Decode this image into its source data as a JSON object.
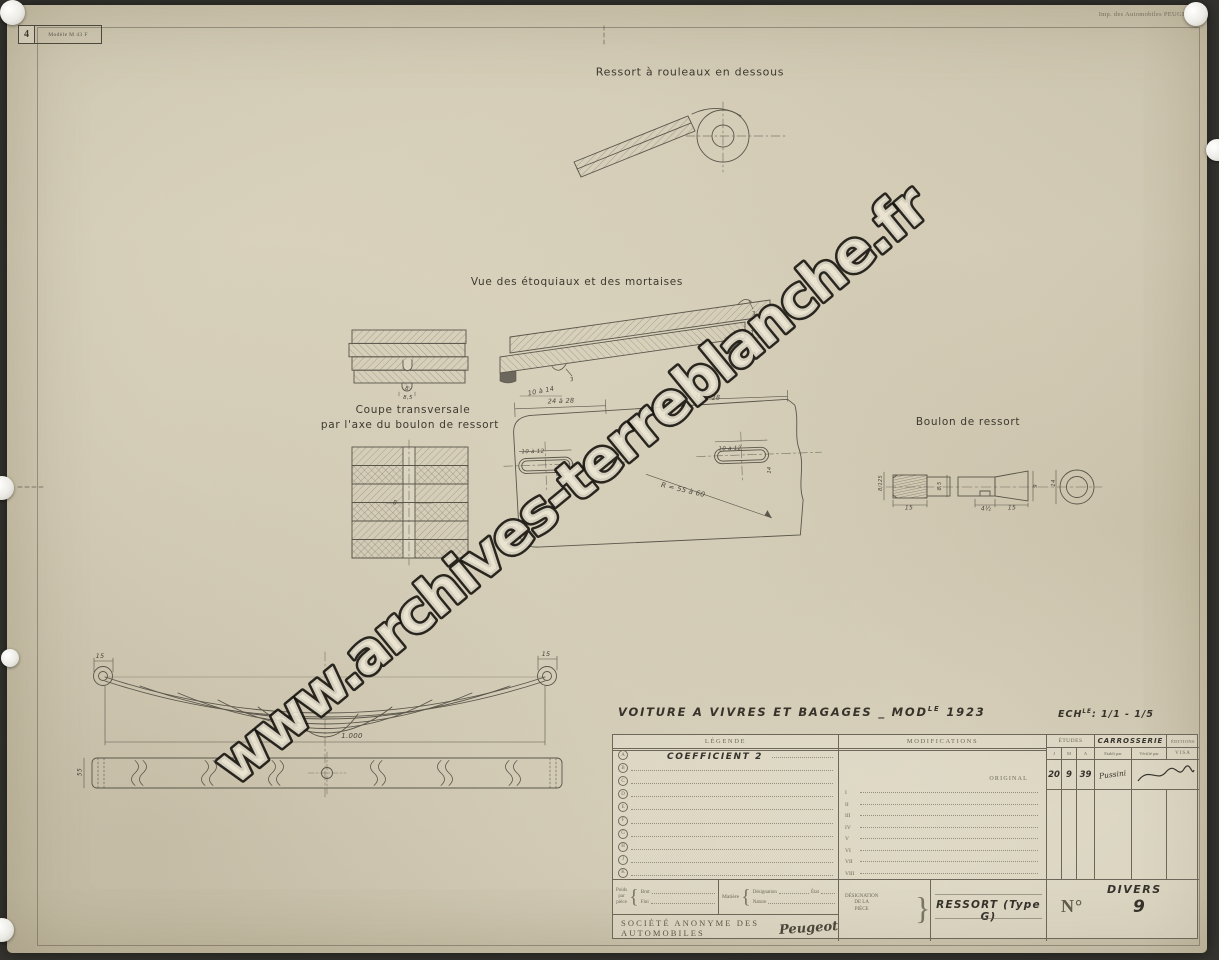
{
  "colors": {
    "paper": "#d9d2bd",
    "ink": "#56524a",
    "table_line": "#6d6759",
    "watermark_fill": "#ece6d4",
    "watermark_stroke": "#16130e"
  },
  "watermark": {
    "text": "www.archives-terreblanche.fr"
  },
  "stamp": {
    "number": "4",
    "model": "Modèle M 43 F"
  },
  "printer_note": "Imp. des Automobiles PEUGEOT.",
  "annotations": [
    {
      "t": "Ressort à rouleaux en dessous",
      "x": 690,
      "y": 72,
      "s": 11,
      "cls": "title"
    },
    {
      "t": "Vue des étoquiaux et des mortaises",
      "x": 577,
      "y": 282,
      "s": 10.5,
      "cls": "title"
    },
    {
      "t": "Coupe transversale",
      "x": 413,
      "y": 410,
      "s": 10.5,
      "cls": "title"
    },
    {
      "t": "par l'axe du boulon de ressort",
      "x": 410,
      "y": 425,
      "s": 10.5,
      "cls": "title"
    },
    {
      "t": "Boulon de ressort",
      "x": 968,
      "y": 422,
      "s": 10.5,
      "cls": "title"
    },
    {
      "t": "10 à 14",
      "x": 541,
      "y": 391,
      "r": -11
    },
    {
      "t": "3",
      "x": 572,
      "y": 380,
      "r": -11,
      "s": 5.5
    },
    {
      "t": "10 à 14",
      "x": 746,
      "y": 334,
      "r": -11
    },
    {
      "t": "3",
      "x": 754,
      "y": 314,
      "r": -11,
      "s": 5.5
    },
    {
      "t": "24 à 28",
      "x": 561,
      "y": 401,
      "r": -2
    },
    {
      "t": "24 à 28",
      "x": 707,
      "y": 398,
      "r": -2
    },
    {
      "t": "10 à 12",
      "x": 533,
      "y": 452,
      "r": -2,
      "s": 5.5
    },
    {
      "t": "10 à 12",
      "x": 730,
      "y": 449,
      "r": -2,
      "s": 5.5
    },
    {
      "t": "5,8",
      "x": 559,
      "y": 472,
      "r": -90,
      "s": 5
    },
    {
      "t": "14",
      "x": 770,
      "y": 470,
      "r": -90,
      "s": 5
    },
    {
      "t": "R = 55 à 60",
      "x": 683,
      "y": 490,
      "r": 13,
      "s": 7
    },
    {
      "t": "8",
      "x": 407,
      "y": 389,
      "s": 5.5
    },
    {
      "t": "8,5",
      "x": 408,
      "y": 398,
      "s": 5.5
    },
    {
      "t": "8",
      "x": 395,
      "y": 503,
      "s": 6
    },
    {
      "t": "8/125",
      "x": 881,
      "y": 483,
      "r": -90,
      "s": 5
    },
    {
      "t": "15",
      "x": 909,
      "y": 508,
      "s": 6
    },
    {
      "t": "8,5",
      "x": 940,
      "y": 486,
      "r": -90,
      "s": 5
    },
    {
      "t": "4½",
      "x": 986,
      "y": 509,
      "s": 6
    },
    {
      "t": "15",
      "x": 1012,
      "y": 508,
      "s": 6
    },
    {
      "t": "9",
      "x": 1036,
      "y": 486,
      "r": -90,
      "s": 5.5
    },
    {
      "t": "14",
      "x": 1054,
      "y": 483,
      "r": -90,
      "s": 5.5
    },
    {
      "t": "15",
      "x": 100,
      "y": 656,
      "s": 6.5
    },
    {
      "t": "15",
      "x": 546,
      "y": 654,
      "s": 6.5
    },
    {
      "t": "1.000",
      "x": 352,
      "y": 736,
      "s": 7
    },
    {
      "t": "55",
      "x": 80,
      "y": 772,
      "r": -90,
      "s": 6
    }
  ],
  "title_block": {
    "brace": "{",
    "project_title": {
      "prefix": "VOITURE A VIVRES ET BAGAGES _ MOD",
      "sup": "LE",
      "year": "1923"
    },
    "scale": {
      "label": "ECH",
      "sup": "LE",
      "value": ": 1/1 - 1/5"
    },
    "legend": {
      "header": "LÉGENDE",
      "rows": [
        {
          "letter": "A",
          "value": "COEFFICIENT 2"
        },
        {
          "letter": "B",
          "value": ""
        },
        {
          "letter": "C",
          "value": ""
        },
        {
          "letter": "D",
          "value": ""
        },
        {
          "letter": "E",
          "value": ""
        },
        {
          "letter": "F",
          "value": ""
        },
        {
          "letter": "G",
          "value": ""
        },
        {
          "letter": "H",
          "value": ""
        },
        {
          "letter": "J",
          "value": ""
        },
        {
          "letter": "K",
          "value": ""
        }
      ]
    },
    "modifications": {
      "header": "MODIFICATIONS",
      "original_label": "ORIGINAL",
      "rows": [
        "I",
        "II",
        "III",
        "IV",
        "V",
        "VI",
        "VII",
        "VIII"
      ]
    },
    "etudes": {
      "dept_label": "ÉTUDES",
      "dept_value": "CARROSSERIE",
      "right_header": "ÉDITIONS",
      "columns": [
        "J",
        "M",
        "A",
        "Etabli par",
        "Vérifié par"
      ],
      "visa_label": "VISA",
      "date": {
        "J": "20",
        "M": "9",
        "A": "39"
      },
      "etabli_signature": "Pussini"
    },
    "weights": {
      "poids_label": "Poids",
      "par_label": "par",
      "piece_label": "pièce",
      "brut_label": "Brut",
      "fini_label": "Fini"
    },
    "material": {
      "matiere_label": "Matière",
      "designation_label": "Désignation",
      "etat_label": "État",
      "nature_label": "Nature"
    },
    "designation": {
      "lines": [
        "DÉSIGNATION",
        "DE LA",
        "PIÈCE"
      ],
      "piece_name": "RESSORT  (Type G)"
    },
    "numero": {
      "label": "N°",
      "category": "DIVERS",
      "value": "9"
    },
    "company": {
      "name": "SOCIÉTÉ ANONYME DES AUTOMOBILES",
      "brand": "Peugeot"
    }
  }
}
